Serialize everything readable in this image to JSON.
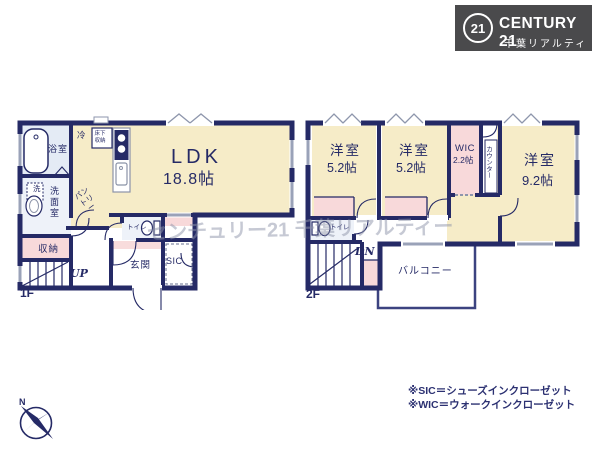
{
  "logo": {
    "badge": "21",
    "brand": "CENTURY 21",
    "company": "千葉リアルティー"
  },
  "watermark": "センチュリー21 千葉リアルティー",
  "floor1": {
    "label": "1F",
    "ldk": {
      "name": "LDK",
      "size": "18.8帖"
    },
    "bathroom": "浴室",
    "refrigerator": "冷",
    "underfloor_storage": "床下収納",
    "washer": "洗",
    "washroom": "洗面室",
    "pantry": "パントリー",
    "toilet": "トイレ",
    "storage": "収納",
    "stairs_up": "UP",
    "entrance": "玄関",
    "shoe_closet": "SIC"
  },
  "floor2": {
    "label": "2F",
    "bedrooms": [
      {
        "name": "洋室",
        "size": "5.2帖"
      },
      {
        "name": "洋室",
        "size": "5.2帖"
      },
      {
        "name": "洋室",
        "size": "9.2帖"
      }
    ],
    "wic": {
      "name": "WIC",
      "size": "2.2帖"
    },
    "counter": "カウンター",
    "toilet": "トイレ",
    "stairs_down": "DN",
    "balcony": "バルコニー"
  },
  "notes": [
    "※SIC＝シューズインクローゼット",
    "※WIC＝ウォークインクローゼット"
  ],
  "compass": {
    "north": "N"
  },
  "colors": {
    "wall": "#252a66",
    "room_cream": "#f6ecc8",
    "room_pink": "#f8d9da",
    "room_bath": "#e9eff6",
    "logo_bg": "#4a4a4c",
    "window": "#9aa2b8",
    "watermark": "#8f95aa",
    "note_text": "#2c3172"
  }
}
